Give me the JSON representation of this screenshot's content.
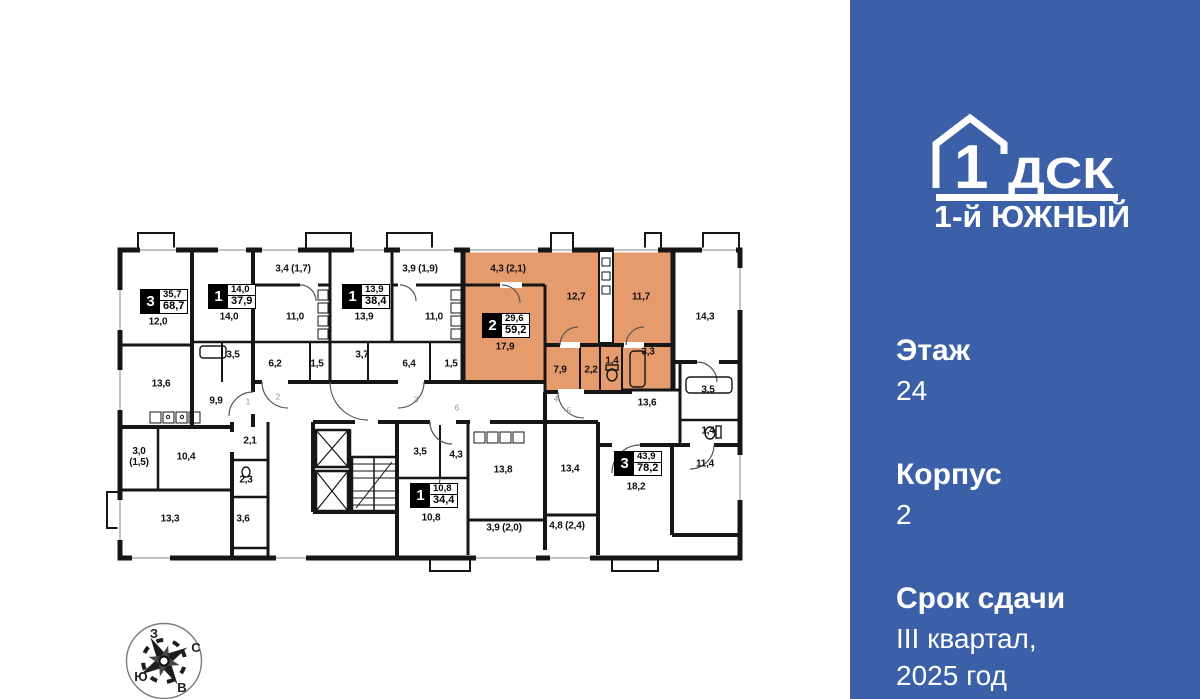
{
  "panel": {
    "bg_color": "#3b60a7",
    "logo": {
      "number": "1",
      "letters": "ДСК",
      "project": "1-й ЮЖНЫЙ"
    },
    "fields": {
      "floor": {
        "label": "Этаж",
        "value": "24"
      },
      "building": {
        "label": "Корпус",
        "value": "2"
      },
      "deadline": {
        "label": "Срок сдачи",
        "value": "III квартал,\n2025 год"
      }
    }
  },
  "compass": {
    "top": "З",
    "right": "С",
    "left": "Ю",
    "bottom": "В"
  },
  "floorplan": {
    "highlight_color": "#e69b6d",
    "wall_color": "#161616",
    "apartments": [
      {
        "rooms": "3",
        "living": "35,7",
        "total": "68,7",
        "x": 140,
        "y": 289,
        "highlighted": false
      },
      {
        "rooms": "1",
        "living": "14,0",
        "total": "37,9",
        "x": 208,
        "y": 284,
        "highlighted": false
      },
      {
        "rooms": "1",
        "living": "13,9",
        "total": "38,4",
        "x": 342,
        "y": 284,
        "highlighted": false
      },
      {
        "rooms": "2",
        "living": "29,6",
        "total": "59,2",
        "x": 482,
        "y": 313,
        "highlighted": true
      },
      {
        "rooms": "1",
        "living": "10,8",
        "total": "34,4",
        "x": 410,
        "y": 483,
        "highlighted": false
      },
      {
        "rooms": "3",
        "living": "43,9",
        "total": "78,2",
        "x": 614,
        "y": 451,
        "highlighted": false
      }
    ],
    "room_labels": [
      {
        "text": "12,0",
        "x": 158,
        "y": 322
      },
      {
        "text": "13,6",
        "x": 161,
        "y": 384
      },
      {
        "text": "9,9",
        "x": 216,
        "y": 401
      },
      {
        "text": "14,0",
        "x": 229,
        "y": 317
      },
      {
        "text": "3,4 (1,7)",
        "x": 293,
        "y": 269
      },
      {
        "text": "11,0",
        "x": 295,
        "y": 317
      },
      {
        "text": "3,5",
        "x": 233,
        "y": 355
      },
      {
        "text": "6,2",
        "x": 275,
        "y": 364
      },
      {
        "text": "1,5",
        "x": 317,
        "y": 364
      },
      {
        "text": "13,9",
        "x": 364,
        "y": 317
      },
      {
        "text": "3,9 (1,9)",
        "x": 420,
        "y": 269
      },
      {
        "text": "11,0",
        "x": 434,
        "y": 317
      },
      {
        "text": "3,7",
        "x": 362,
        "y": 355
      },
      {
        "text": "6,4",
        "x": 409,
        "y": 364
      },
      {
        "text": "1,5",
        "x": 451,
        "y": 364
      },
      {
        "text": "4,3 (2,1)",
        "x": 508,
        "y": 269
      },
      {
        "text": "17,9",
        "x": 505,
        "y": 347
      },
      {
        "text": "12,7",
        "x": 576,
        "y": 297
      },
      {
        "text": "11,7",
        "x": 641,
        "y": 297
      },
      {
        "text": "7,9",
        "x": 560,
        "y": 370
      },
      {
        "text": "2,2",
        "x": 591,
        "y": 370
      },
      {
        "text": "1,4",
        "x": 612,
        "y": 361
      },
      {
        "text": "3,3",
        "x": 648,
        "y": 352
      },
      {
        "text": "14,3",
        "x": 705,
        "y": 317
      },
      {
        "text": "13,6",
        "x": 647,
        "y": 403
      },
      {
        "text": "3,5",
        "x": 708,
        "y": 390
      },
      {
        "text": "1,4",
        "x": 708,
        "y": 431
      },
      {
        "text": "11,4",
        "x": 705,
        "y": 464
      },
      {
        "text": "18,2",
        "x": 636,
        "y": 487
      },
      {
        "text": "3,0\n(1,5)",
        "x": 139,
        "y": 457
      },
      {
        "text": "10,4",
        "x": 186,
        "y": 457
      },
      {
        "text": "13,3",
        "x": 170,
        "y": 519
      },
      {
        "text": "2,1",
        "x": 250,
        "y": 441
      },
      {
        "text": "2,3",
        "x": 246,
        "y": 480
      },
      {
        "text": "3,6",
        "x": 243,
        "y": 519
      },
      {
        "text": "3,5",
        "x": 420,
        "y": 452
      },
      {
        "text": "4,3",
        "x": 456,
        "y": 455
      },
      {
        "text": "10,8",
        "x": 431,
        "y": 518
      },
      {
        "text": "13,8",
        "x": 503,
        "y": 470
      },
      {
        "text": "13,4",
        "x": 570,
        "y": 469
      },
      {
        "text": "3,9 (2,0)",
        "x": 504,
        "y": 528
      },
      {
        "text": "4,8 (2,4)",
        "x": 567,
        "y": 526
      }
    ],
    "unit_numbers": [
      {
        "text": "1",
        "x": 248,
        "y": 402
      },
      {
        "text": "2",
        "x": 278,
        "y": 397
      },
      {
        "text": "3",
        "x": 416,
        "y": 400
      },
      {
        "text": "4",
        "x": 556,
        "y": 399
      },
      {
        "text": "5",
        "x": 569,
        "y": 411
      },
      {
        "text": "6",
        "x": 457,
        "y": 408
      }
    ]
  }
}
